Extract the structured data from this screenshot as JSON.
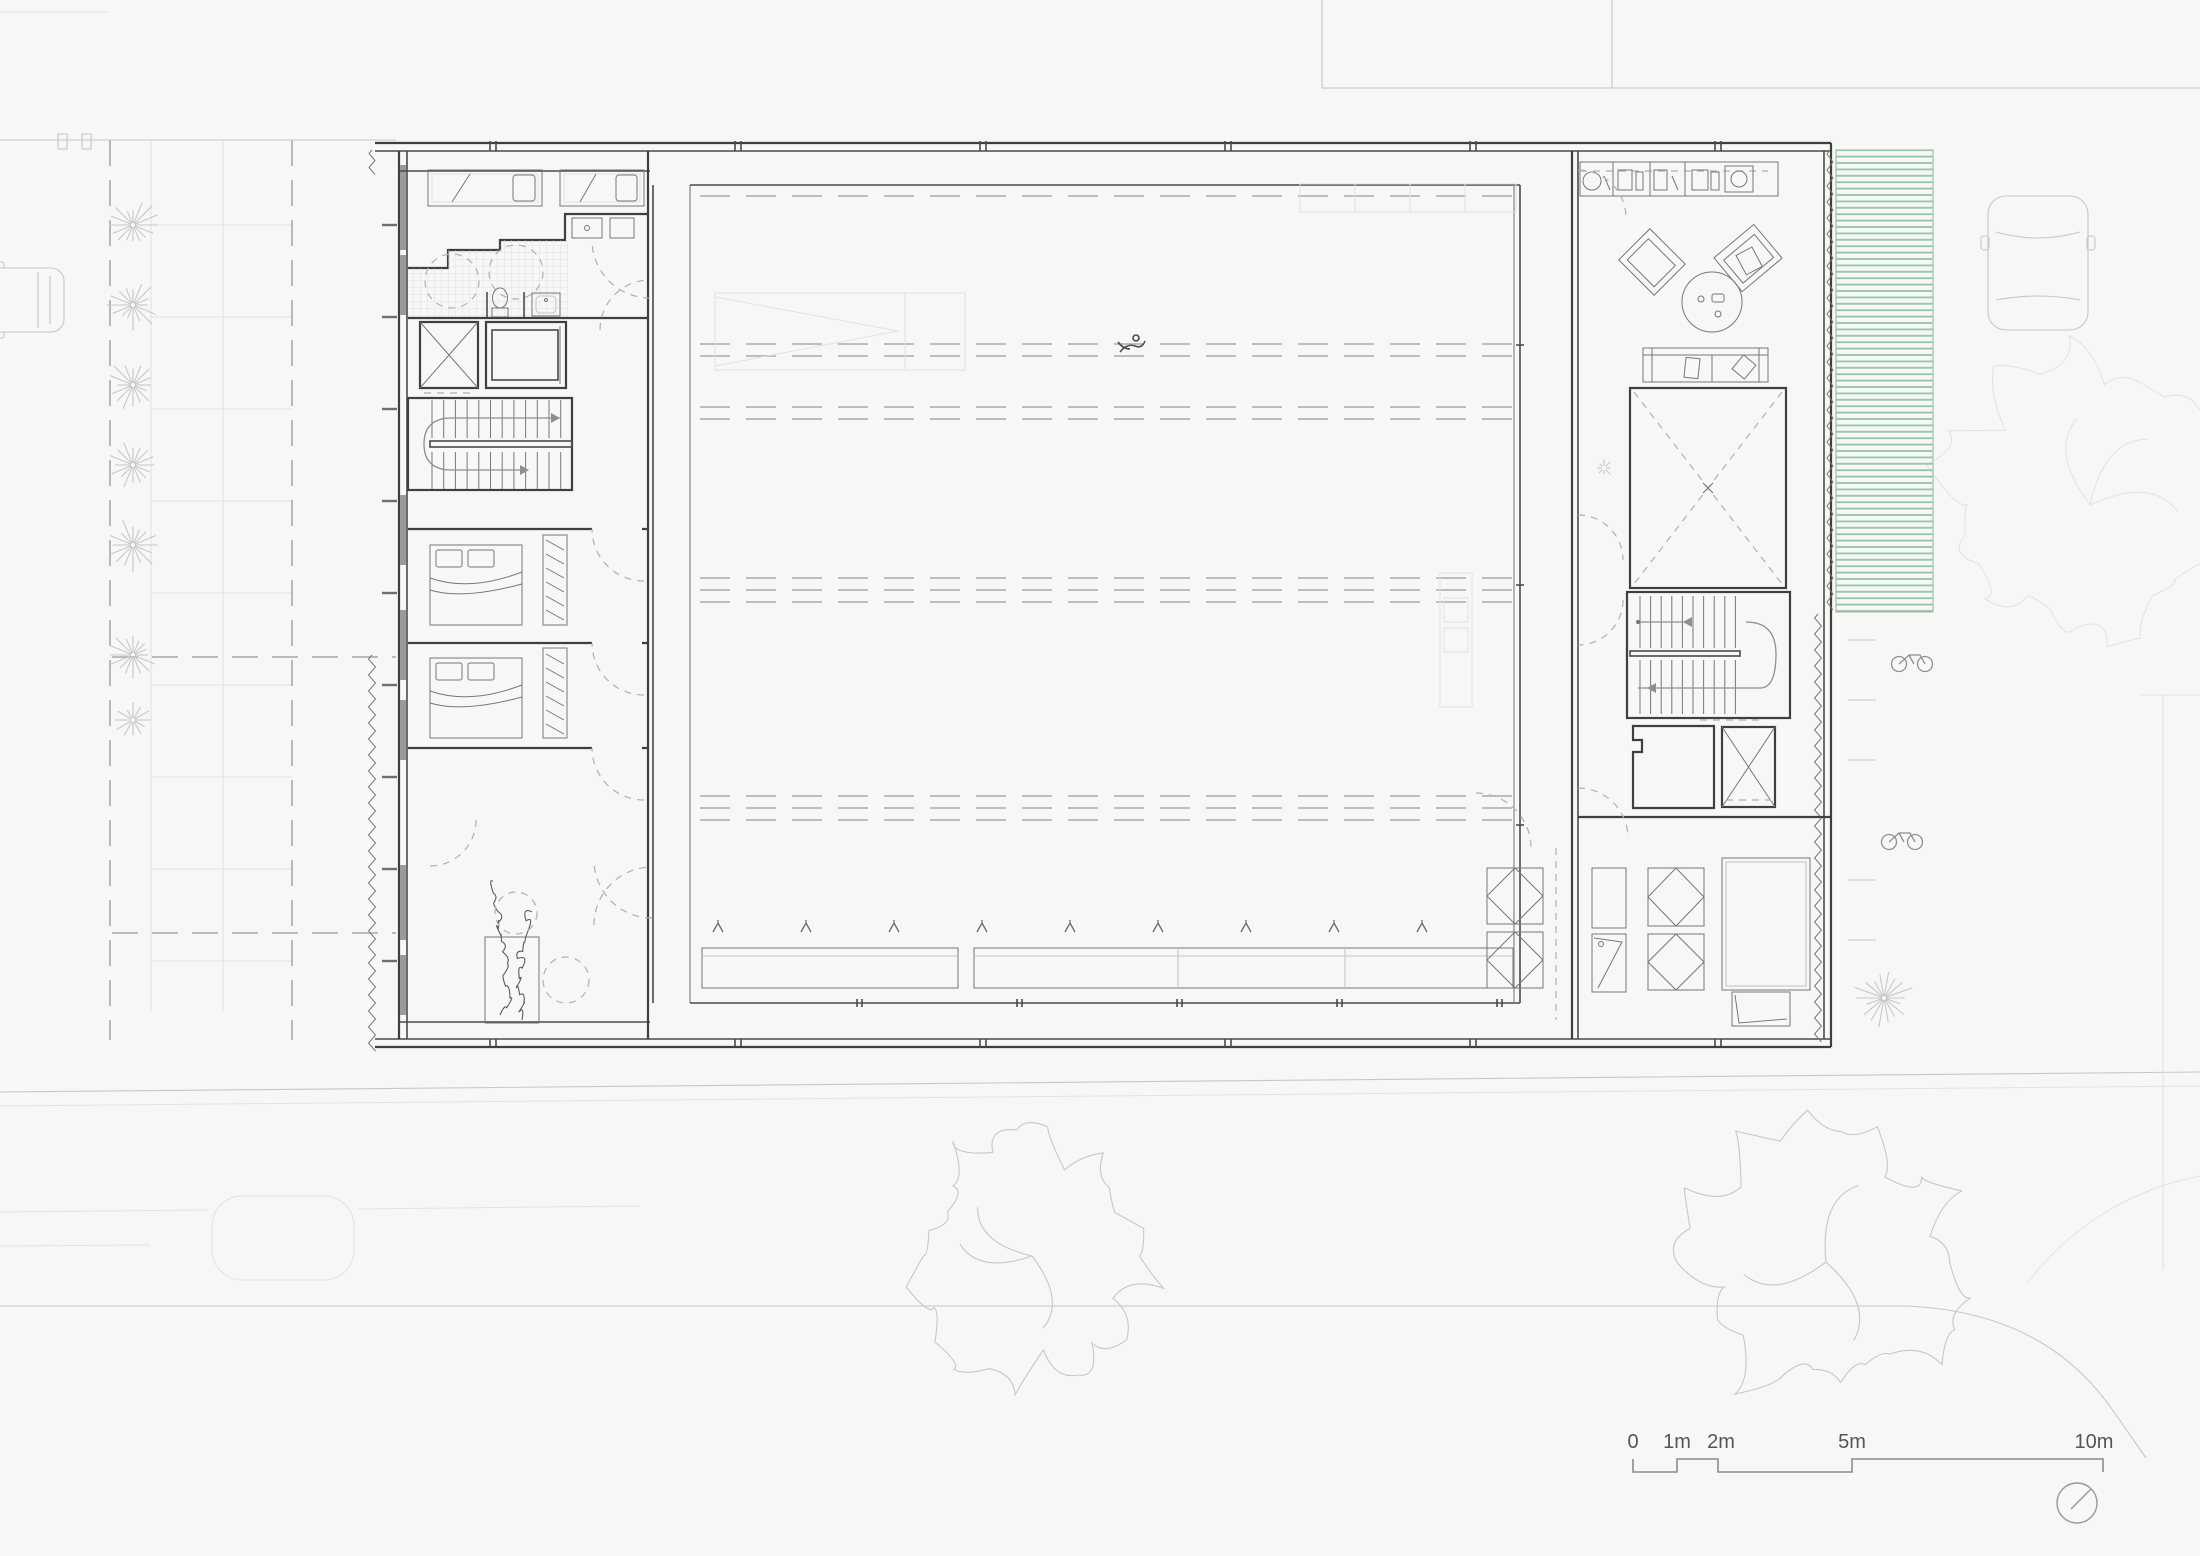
{
  "drawing": {
    "kind": "architectural floor plan",
    "scale_bar": {
      "labels": [
        "0",
        "1m",
        "2m",
        "5m",
        "10m"
      ]
    },
    "icons": [
      "north-indicator-icon",
      "single-bed-icon",
      "double-bed-icon",
      "wardrobe-icon",
      "bathtub-shower-circle-icon",
      "toilet-icon",
      "sink-icon",
      "elevator-icon",
      "stair-run-icon",
      "kitchen-counter-icon",
      "armchair-icon",
      "round-table-icon",
      "sofa-icon",
      "void-cross-icon",
      "diamond-table-icon",
      "tree-icon",
      "shrub-icon",
      "car-icon",
      "bicycle-icon",
      "planting-strip-icon",
      "swimmer-icon"
    ],
    "colors": {
      "wall": "#3f3f3f",
      "med": "#8f8f8f",
      "lt": "#c7c7c7",
      "xlt": "#e2e2e2",
      "dsh": "#a8a8a8",
      "green": "#8fc1a3",
      "bg": "#f7f7f6",
      "tile": "#d9d9d9",
      "ink": "#555555"
    }
  }
}
